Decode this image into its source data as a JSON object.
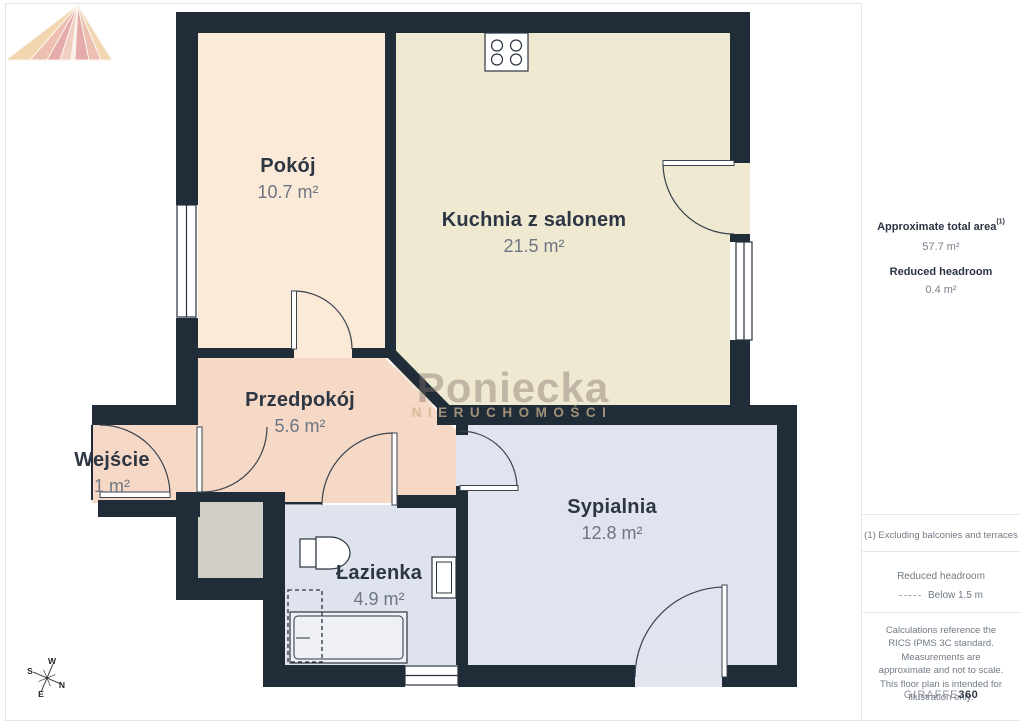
{
  "floor_plan": {
    "rooms": [
      {
        "name": "Pokój",
        "area": "10.7 m²"
      },
      {
        "name": "Kuchnia z salonem",
        "area": "21.5 m²"
      },
      {
        "name": "Przedpokój",
        "area": "5.6 m²"
      },
      {
        "name": "Wejście",
        "area": "1 m²"
      },
      {
        "name": "Łazienka",
        "area": "4.9 m²"
      },
      {
        "name": "Sypialnia",
        "area": "12.8 m²"
      }
    ],
    "watermark": {
      "brand": "Poniecka",
      "subtitle": "NIERUCHOMOŚCI"
    },
    "compass": {
      "north": "N",
      "south": "S",
      "east": "E",
      "west": "W"
    }
  },
  "sidebar": {
    "approx_area_label": "Approximate total area",
    "approx_area_note_ref": "(1)",
    "approx_area_value": "57.7 m²",
    "reduced_headroom_label": "Reduced headroom",
    "reduced_headroom_value": "0.4 m²",
    "footnote": "(1) Excluding balconies and terraces",
    "legend_label": "Reduced headroom",
    "legend_value": "Below 1.5 m",
    "disclaimer": "Calculations reference the RICS IPMS 3C standard. Measurements are approximate and not to scale. This floor plan is intended for illustration only.",
    "brand_prefix": "GIRAFFE",
    "brand_suffix": "360"
  },
  "colors": {
    "wall": "#212c39",
    "room_pokoj": "#fcead9",
    "room_kitchen": "#f0e9d2",
    "room_hall": "#f6d8c6",
    "room_bath": "#dfe3ed",
    "room_bedroom": "#e1e4ee",
    "shaft": "#d1cec7"
  }
}
